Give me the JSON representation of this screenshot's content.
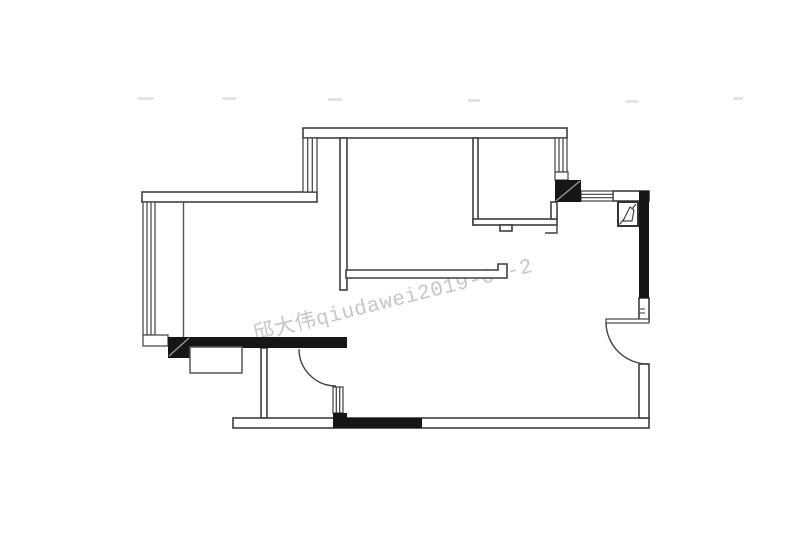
{
  "document": {
    "kind": "apartment-floor-plan",
    "background": "#ffffff"
  },
  "watermark": {
    "text": "邱大伟qiudawei2019-04-2",
    "color": "#c6c6c6",
    "rotation_deg": -14
  },
  "palette": {
    "wall_fill_black": "#161616",
    "wall_outline": "#3f3f3f",
    "thin_line": "#555555",
    "column_slash": "#9a9a9a",
    "watermark_gray": "#c6c6c6",
    "remnant_gray": "#e3e3e3"
  },
  "plan": {
    "visible_symbols": [
      "exterior walls (double-line)",
      "load-bearing walls (solid black)",
      "left full-height window",
      "stepped bay window (top)",
      "kitchen enclosure with bottom door-stop tab",
      "kitchen right window with sill box",
      "two black structural columns with diagonal slash",
      "flue shaft symbol (square with folded diagonal)",
      "top-right horizontal window",
      "interior T-partition wall with hooked end",
      "bathroom partition with swing door arc and sidelight window",
      "right-wall swing door with leaf and arc",
      "low cabinet rectangle below black wall",
      "bottom wall with black infill segment",
      "faded watermark remnants (upper row)"
    ]
  }
}
